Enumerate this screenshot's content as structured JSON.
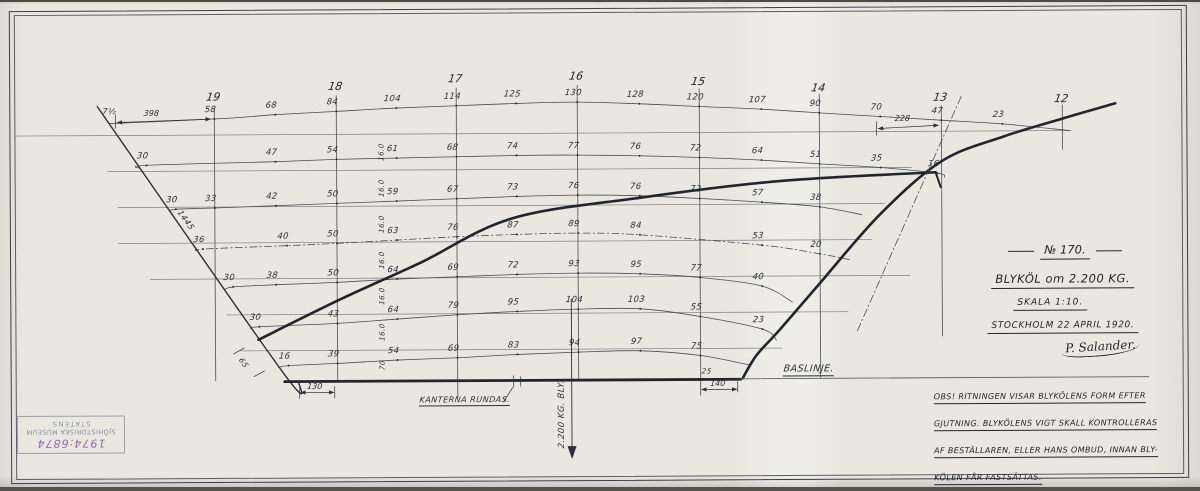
{
  "title_block": {
    "drawing_no": "№ 170.",
    "title": "BLYKÖL om 2.200 KG.",
    "scale": "SKALA 1:10.",
    "place_date": "STOCKHOLM 22 APRIL 1920.",
    "signature": "P. Salander."
  },
  "note": {
    "lines": [
      "OBS! RITNINGEN VISAR BLYKÖLENS FORM EFTER",
      "GJUTNING. BLYKÖLENS VIGT SKALL KONTROLLERAS",
      "AF BESTÄLLAREN, ELLER HANS OMBUD, INNAN BLY-",
      "KÖLEN FÅR FASTSÄTTAS."
    ]
  },
  "stamp": {
    "line1": "STATENS",
    "line2": "SJÖHISTORISKA MUSEUM",
    "number": "1974:6874"
  },
  "colors": {
    "paper": "#e9e7e0",
    "ink": "#2c2f36",
    "thick": "#22252b",
    "grid": "#7b7e84",
    "grid_dark": "#5c5f66",
    "curve": "#4a4e55",
    "stamp_blue": "#9aa0b2",
    "stamp_purple": "#8d6cab"
  },
  "grid": {
    "waterlines": [
      {
        "y": 133,
        "x1": 16,
        "x2": 1072
      },
      {
        "y": 169,
        "x1": 108,
        "x2": 912
      },
      {
        "y": 205,
        "x1": 118,
        "x2": 885
      },
      {
        "y": 241,
        "x1": 118,
        "x2": 872
      },
      {
        "y": 277,
        "x1": 150,
        "x2": 910
      },
      {
        "y": 313,
        "x1": 226,
        "x2": 848
      },
      {
        "y": 349,
        "x1": 240,
        "x2": 782
      }
    ],
    "stations": [
      {
        "label": "19",
        "x": 215,
        "y1": 106,
        "y2": 379,
        "lx": 214,
        "ly": 95
      },
      {
        "label": "18",
        "x": 337,
        "y1": 94,
        "y2": 379,
        "lx": 336,
        "ly": 85
      },
      {
        "label": "17",
        "x": 457,
        "y1": 87,
        "y2": 397,
        "lx": 456,
        "ly": 78
      },
      {
        "label": "16",
        "x": 578,
        "y1": 85,
        "y2": 379,
        "lx": 577,
        "ly": 76
      },
      {
        "label": "15",
        "x": 700,
        "y1": 89,
        "y2": 379,
        "lx": 699,
        "ly": 82
      },
      {
        "label": "14",
        "x": 820,
        "y1": 95,
        "y2": 379,
        "lx": 819,
        "ly": 89
      },
      {
        "label": "13",
        "x": 942,
        "y1": 107,
        "y2": 338,
        "lx": 941,
        "ly": 99
      },
      {
        "label": "12",
        "x": 1063,
        "y1": 107,
        "y2": 152,
        "lx": 1062,
        "ly": 101
      }
    ]
  },
  "offset_rows": [
    {
      "name": "waterline-0",
      "style": "solid",
      "ext1": [
        110,
        121
      ],
      "ext2": [
        1070,
        133
      ],
      "points": [
        {
          "x": 215,
          "y": 117,
          "v": "58"
        },
        {
          "x": 276,
          "y": 113,
          "v": "68"
        },
        {
          "x": 337,
          "y": 110,
          "v": "84"
        },
        {
          "x": 397,
          "y": 107,
          "v": "104"
        },
        {
          "x": 457,
          "y": 105,
          "v": "114"
        },
        {
          "x": 517,
          "y": 103,
          "v": "125"
        },
        {
          "x": 578,
          "y": 102,
          "v": "130"
        },
        {
          "x": 640,
          "y": 104,
          "v": "128"
        },
        {
          "x": 700,
          "y": 107,
          "v": "120"
        },
        {
          "x": 762,
          "y": 110,
          "v": "107"
        },
        {
          "x": 820,
          "y": 114,
          "v": "90"
        },
        {
          "x": 881,
          "y": 118,
          "v": "70"
        },
        {
          "x": 942,
          "y": 122,
          "v": "47"
        },
        {
          "x": 1003,
          "y": 126,
          "v": "23"
        }
      ]
    },
    {
      "name": "waterline-1",
      "style": "solid",
      "ext1": [
        141,
        166
      ],
      "ext2": [
        945,
        179
      ],
      "points": [
        {
          "x": 147,
          "y": 163,
          "v": "30"
        },
        {
          "x": 276,
          "y": 160,
          "v": "47"
        },
        {
          "x": 337,
          "y": 158,
          "v": "54"
        },
        {
          "x": 397,
          "y": 157,
          "v": "61"
        },
        {
          "x": 457,
          "y": 156,
          "v": "68"
        },
        {
          "x": 517,
          "y": 155,
          "v": "74"
        },
        {
          "x": 578,
          "y": 155,
          "v": "77"
        },
        {
          "x": 640,
          "y": 156,
          "v": "76"
        },
        {
          "x": 700,
          "y": 158,
          "v": "72"
        },
        {
          "x": 762,
          "y": 161,
          "v": "64"
        },
        {
          "x": 820,
          "y": 165,
          "v": "51"
        },
        {
          "x": 881,
          "y": 169,
          "v": "35"
        },
        {
          "x": 938,
          "y": 175,
          "v": "16"
        }
      ]
    },
    {
      "name": "waterline-2",
      "style": "solid",
      "ext1": [
        170,
        209
      ],
      "ext2": [
        862,
        216
      ],
      "points": [
        {
          "x": 176,
          "y": 207,
          "v": "30"
        },
        {
          "x": 215,
          "y": 206,
          "v": "33"
        },
        {
          "x": 276,
          "y": 204,
          "v": "42"
        },
        {
          "x": 337,
          "y": 202,
          "v": "50"
        },
        {
          "x": 397,
          "y": 200,
          "v": "59"
        },
        {
          "x": 457,
          "y": 198,
          "v": "67"
        },
        {
          "x": 517,
          "y": 196,
          "v": "73"
        },
        {
          "x": 578,
          "y": 195,
          "v": "76"
        },
        {
          "x": 640,
          "y": 196,
          "v": "76"
        },
        {
          "x": 700,
          "y": 199,
          "v": "72"
        },
        {
          "x": 762,
          "y": 203,
          "v": "57"
        },
        {
          "x": 820,
          "y": 208,
          "v": "38"
        }
      ]
    },
    {
      "name": "waterline-3",
      "style": "dashdot",
      "ext1": [
        198,
        249
      ],
      "ext2": [
        850,
        261
      ],
      "points": [
        {
          "x": 203,
          "y": 247,
          "v": "36"
        },
        {
          "x": 287,
          "y": 244,
          "v": "40"
        },
        {
          "x": 337,
          "y": 242,
          "v": "50"
        },
        {
          "x": 397,
          "y": 239,
          "v": "63"
        },
        {
          "x": 457,
          "y": 236,
          "v": "76"
        },
        {
          "x": 517,
          "y": 234,
          "v": "87"
        },
        {
          "x": 578,
          "y": 233,
          "v": "89"
        },
        {
          "x": 640,
          "y": 235,
          "v": "84"
        },
        {
          "x": 762,
          "y": 246,
          "v": "53"
        },
        {
          "x": 820,
          "y": 255,
          "v": "20"
        }
      ]
    },
    {
      "name": "waterline-4",
      "style": "solid",
      "ext1": [
        224,
        288
      ],
      "ext2": [
        792,
        303
      ],
      "points": [
        {
          "x": 233,
          "y": 285,
          "v": "30"
        },
        {
          "x": 276,
          "y": 283,
          "v": "38"
        },
        {
          "x": 337,
          "y": 281,
          "v": "50"
        },
        {
          "x": 397,
          "y": 278,
          "v": "64"
        },
        {
          "x": 457,
          "y": 276,
          "v": "69"
        },
        {
          "x": 517,
          "y": 274,
          "v": "72"
        },
        {
          "x": 578,
          "y": 273,
          "v": "93"
        },
        {
          "x": 640,
          "y": 274,
          "v": "95"
        },
        {
          "x": 700,
          "y": 278,
          "v": "77"
        },
        {
          "x": 762,
          "y": 287,
          "v": "40"
        }
      ]
    },
    {
      "name": "waterline-5",
      "style": "solid",
      "ext1": [
        251,
        327
      ],
      "ext2": [
        776,
        341
      ],
      "points": [
        {
          "x": 259,
          "y": 325,
          "v": "30"
        },
        {
          "x": 337,
          "y": 322,
          "v": "43"
        },
        {
          "x": 397,
          "y": 318,
          "v": "64"
        },
        {
          "x": 457,
          "y": 314,
          "v": "79"
        },
        {
          "x": 517,
          "y": 311,
          "v": "95"
        },
        {
          "x": 578,
          "y": 309,
          "v": "104"
        },
        {
          "x": 640,
          "y": 309,
          "v": "103"
        },
        {
          "x": 700,
          "y": 317,
          "v": "55"
        },
        {
          "x": 762,
          "y": 330,
          "v": "23"
        }
      ]
    },
    {
      "name": "waterline-6",
      "style": "solid",
      "ext1": [
        278,
        366
      ],
      "ext2": [
        750,
        366
      ],
      "points": [
        {
          "x": 288,
          "y": 364,
          "v": "16"
        },
        {
          "x": 337,
          "y": 362,
          "v": "39"
        },
        {
          "x": 397,
          "y": 359,
          "v": "54"
        },
        {
          "x": 457,
          "y": 357,
          "v": "69"
        },
        {
          "x": 517,
          "y": 354,
          "v": "83"
        },
        {
          "x": 578,
          "y": 352,
          "v": "94"
        },
        {
          "x": 640,
          "y": 351,
          "v": "97"
        },
        {
          "x": 700,
          "y": 356,
          "v": "75"
        }
      ]
    }
  ],
  "outline": {
    "left_slant": {
      "pts": [
        [
          98,
          104
        ],
        [
          281,
          369
        ],
        [
          298,
          380
        ]
      ],
      "w": 1.4
    },
    "keel_top": {
      "pts": [
        [
          258,
          338
        ],
        [
          340,
          298
        ],
        [
          420,
          262
        ],
        [
          512,
          218
        ],
        [
          640,
          198
        ],
        [
          780,
          182
        ],
        [
          936,
          174
        ]
      ],
      "w": 2.6
    },
    "keel_top_hook": {
      "pts": [
        [
          936,
          174
        ],
        [
          941,
          189
        ]
      ],
      "w": 2
    },
    "aft_sweep": {
      "pts": [
        [
          742,
          379
        ],
        [
          756,
          356
        ],
        [
          779,
          331
        ],
        [
          820,
          284
        ],
        [
          880,
          216
        ],
        [
          942,
          163
        ],
        [
          1003,
          139
        ],
        [
          1063,
          121
        ],
        [
          1116,
          106
        ]
      ],
      "w": 2.6
    },
    "baseline_thick": {
      "pts": [
        [
          284,
          380
        ],
        [
          740,
          380
        ]
      ],
      "w": 2.8
    },
    "baseline_thin": {
      "pts": [
        [
          740,
          379.5
        ],
        [
          1148,
          379.5
        ]
      ],
      "w": 0.9
    },
    "construction_dashdot": {
      "pts": [
        [
          857,
          332
        ],
        [
          963,
          96
        ]
      ],
      "w": 0.8,
      "dash": "8 3 1.5 3"
    },
    "cg_line": {
      "pts": [
        [
          571,
          299
        ],
        [
          571,
          448
        ]
      ],
      "w": 0.9
    },
    "cg_arrow_tip": [
      [
        566.5,
        446
      ],
      [
        575.5,
        446
      ],
      [
        571,
        459
      ]
    ]
  },
  "dimensions": [
    {
      "label": "398",
      "x1": 118,
      "y1": 120,
      "x2": 211,
      "y2": 117,
      "lx": 152,
      "ly": 111
    },
    {
      "label": "228",
      "x1": 879,
      "y1": 130,
      "x2": 939,
      "y2": 127,
      "lx": 903,
      "ly": 120
    },
    {
      "label": "130",
      "x1": 300,
      "y1": 391,
      "x2": 333,
      "y2": 391,
      "lx": 314,
      "ly": 385
    },
    {
      "label": "140",
      "x1": 701,
      "y1": 390,
      "x2": 736,
      "y2": 390,
      "lx": 717,
      "ly": 384
    }
  ],
  "ticks": [
    [
      116,
      112,
      116,
      126
    ],
    [
      877,
      123,
      877,
      137
    ],
    [
      513,
      375,
      513,
      387
    ],
    [
      520,
      376,
      520,
      386
    ],
    [
      737,
      382,
      737,
      393
    ],
    [
      299,
      385,
      299,
      397
    ],
    [
      334,
      385,
      334,
      397
    ],
    [
      700,
      380,
      700,
      396
    ],
    [
      233,
      352,
      244,
      346
    ],
    [
      253,
      375,
      264,
      369
    ],
    [
      503,
      401,
      512,
      387
    ]
  ],
  "labels": [
    {
      "text": "BASLINJE.",
      "cx": 808,
      "cy": 371,
      "size": 9.5,
      "u": true,
      "name": "baseline-label"
    },
    {
      "text": "KANTERNA RUNDAS.",
      "cx": 464,
      "cy": 400,
      "size": 8,
      "u": true,
      "name": "edges-rounded-label"
    },
    {
      "text": "2.200 KG. BLY.",
      "cx": 561,
      "cy": 414,
      "size": 8.5,
      "rot": -90,
      "name": "lead-weight-label"
    },
    {
      "text": "1445",
      "cx": 186,
      "cy": 218,
      "size": 8,
      "rot": 54,
      "name": "slant-length-label"
    },
    {
      "text": "65",
      "cx": 243,
      "cy": 361,
      "size": 7.5,
      "rot": 54,
      "name": "corner-dim-label"
    },
    {
      "text": "25",
      "cx": 706,
      "cy": 372,
      "size": 7,
      "name": "small-dim-label"
    },
    {
      "text": "7½",
      "cx": 110,
      "cy": 109,
      "size": 8,
      "name": "left-end-value"
    },
    {
      "text": "16.0",
      "cx": 382,
      "cy": 151,
      "size": 7,
      "rot": -90,
      "name": "spacing-label"
    },
    {
      "text": "16.0",
      "cx": 382,
      "cy": 187,
      "size": 7,
      "rot": -90,
      "name": "spacing-label"
    },
    {
      "text": "16.0",
      "cx": 382,
      "cy": 223,
      "size": 7,
      "rot": -90,
      "name": "spacing-label"
    },
    {
      "text": "16.0",
      "cx": 382,
      "cy": 259,
      "size": 7,
      "rot": -90,
      "name": "spacing-label"
    },
    {
      "text": "16.0",
      "cx": 382,
      "cy": 295,
      "size": 7,
      "rot": -90,
      "name": "spacing-label"
    },
    {
      "text": "16.0",
      "cx": 382,
      "cy": 331,
      "size": 7,
      "rot": -90,
      "name": "spacing-label"
    },
    {
      "text": "70",
      "cx": 382,
      "cy": 364,
      "size": 7,
      "rot": -90,
      "name": "spacing-label"
    }
  ]
}
